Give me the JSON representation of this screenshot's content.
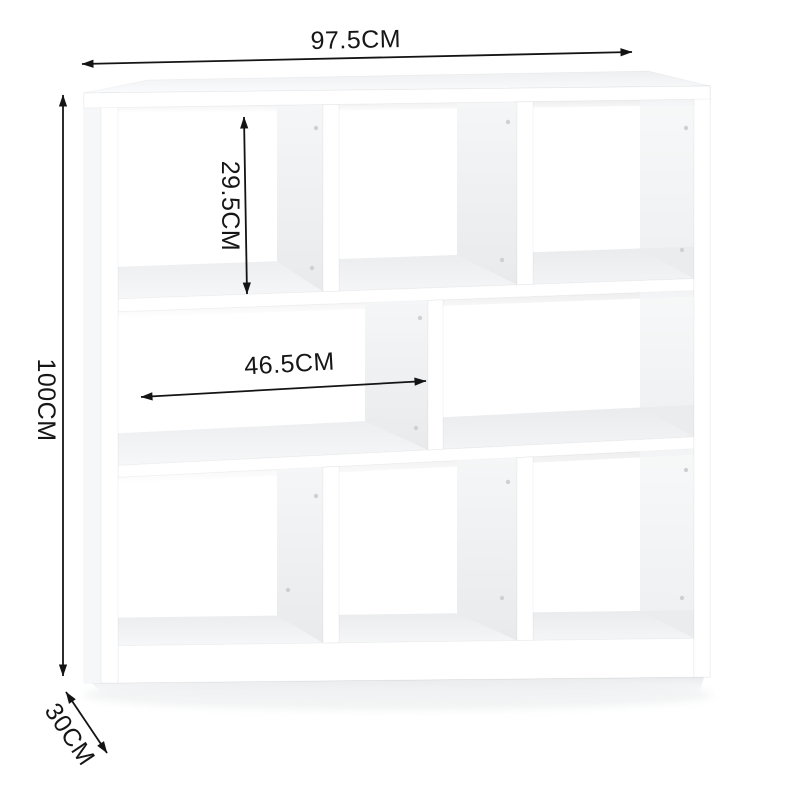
{
  "meta": {
    "description": "White 8-cube staggered bookshelf product dimension diagram",
    "background_color": "#ffffff"
  },
  "dimensions": {
    "overall_width": "97.5CM",
    "overall_height": "100CM",
    "depth": "30CM",
    "cubby_height": "29.5CM",
    "middle_shelf_width": "46.5CM"
  },
  "style": {
    "dimension_line_color": "#141414",
    "panel_shade_color": "#eceef0",
    "surface_shade_color": "#f1f3f4",
    "shelf_color": "#ffffff"
  }
}
